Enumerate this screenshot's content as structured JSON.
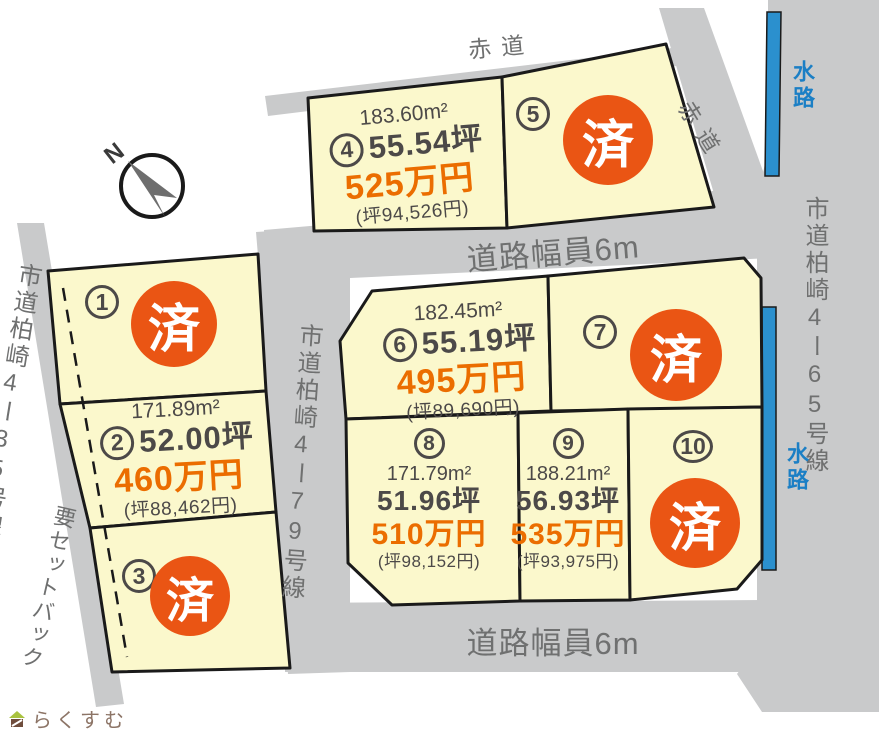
{
  "site_plan": {
    "compass_north": "N",
    "logo_text": "らくすむ",
    "roads": {
      "akamichi_top": "赤道",
      "akamichi_right": "赤道",
      "width_top": "道路幅員6m",
      "width_bottom": "道路幅員6m",
      "road_left": "市道柏崎4ー35号線",
      "road_center": "市道柏崎4ー79号線",
      "road_right": "市道柏崎4ー65号線",
      "setback": "要セットバック",
      "water_top": "水路",
      "water_right": "水路"
    },
    "plots": [
      {
        "no": "1",
        "sold": "済"
      },
      {
        "no": "2",
        "area_m2": "171.89m²",
        "area_tsubo": "52.00坪",
        "price": "460万円",
        "unit_price": "(坪88,462円)"
      },
      {
        "no": "3",
        "sold": "済"
      },
      {
        "no": "4",
        "area_m2": "183.60m²",
        "area_tsubo": "55.54坪",
        "price": "525万円",
        "unit_price": "(坪94,526円)"
      },
      {
        "no": "5",
        "sold": "済"
      },
      {
        "no": "6",
        "area_m2": "182.45m²",
        "area_tsubo": "55.19坪",
        "price": "495万円",
        "unit_price": "(坪89,690円)"
      },
      {
        "no": "7",
        "sold": "済"
      },
      {
        "no": "8",
        "area_m2": "171.79m²",
        "area_tsubo": "51.96坪",
        "price": "510万円",
        "unit_price": "(坪98,152円)"
      },
      {
        "no": "9",
        "area_m2": "188.21m²",
        "area_tsubo": "56.93坪",
        "price": "535万円",
        "unit_price": "(坪93,975円)"
      },
      {
        "no": "10",
        "sold": "済"
      }
    ],
    "colors": {
      "plot_fill": "#FBF8CC",
      "plot_border": "#1A1A1A",
      "road_fill": "#C9CACB",
      "road_text": "#6F7070",
      "sold_circle": "#EA5514",
      "price_text": "#EB6D00",
      "dark_text": "#4C4948",
      "water": "#2B90CE",
      "logo_brown": "#8C7466",
      "logo_green": "#A9C23F"
    }
  }
}
